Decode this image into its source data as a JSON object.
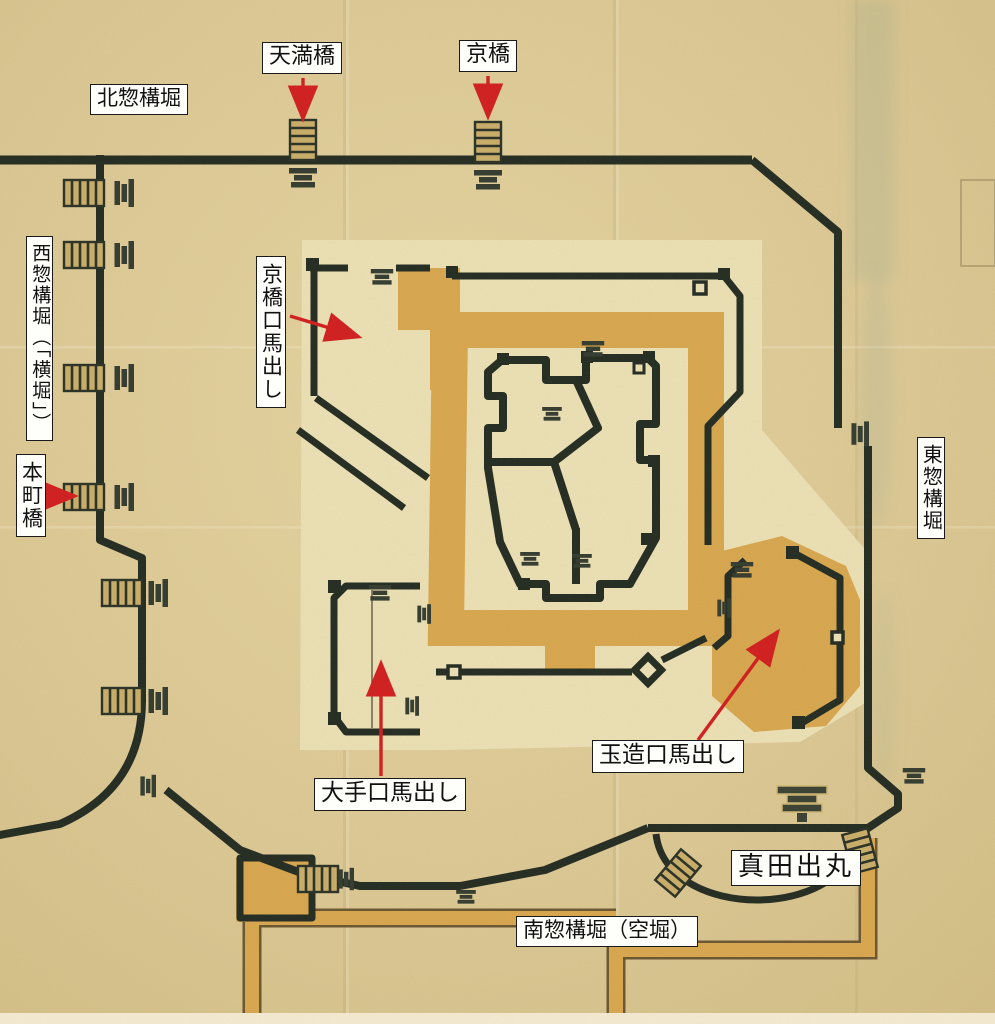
{
  "map_subject": "castle moat plan",
  "colors": {
    "paper": "#d9c58f",
    "paper_light": "#e8d8a8",
    "moat": "#7ba38d",
    "moat_edge": "#557f69",
    "wall": "#242c22",
    "ochre": "#d7a64f",
    "ochre_edge": "#6a5630",
    "cream": "#ebdfb4",
    "bridge": "#c9ad6a",
    "arrow": "#d01f1f",
    "label_bg": "#fefefa",
    "label_border": "#1a1a1a",
    "ink": "#111111"
  },
  "labels": [
    {
      "id": "kita-sogamae-bori",
      "text": "北惣構堀",
      "orientation": "horizontal"
    },
    {
      "id": "temma-bashi",
      "text": "天満橋",
      "orientation": "horizontal"
    },
    {
      "id": "kyo-bashi",
      "text": "京橋",
      "orientation": "horizontal"
    },
    {
      "id": "nishi-sogamae-bori",
      "text": "西惣構堀（「横堀」）",
      "orientation": "vertical"
    },
    {
      "id": "hommachi-bashi",
      "text": "本町橋",
      "orientation": "vertical"
    },
    {
      "id": "kyobashi-guchi-umadashi",
      "text": "京橋口馬出し",
      "orientation": "vertical"
    },
    {
      "id": "higashi-sogamae-bori",
      "text": "東惣構堀",
      "orientation": "vertical"
    },
    {
      "id": "ote-guchi-umadashi",
      "text": "大手口馬出し",
      "orientation": "horizontal"
    },
    {
      "id": "tamatsukuri-guchi-umadashi",
      "text": "玉造口馬出し",
      "orientation": "horizontal"
    },
    {
      "id": "sanada-demaru",
      "text": "真田出丸",
      "orientation": "horizontal"
    },
    {
      "id": "minami-sogamae-bori",
      "text": "南惣構堀（空堀）",
      "orientation": "horizontal"
    }
  ],
  "icons": {
    "bridge": "hatched-bridge-icon",
    "gate": "gate-step-icon",
    "pagoda": "pagoda-gate-icon"
  },
  "bridges": [
    {
      "x": 303,
      "y": 140,
      "r": 0
    },
    {
      "x": 488,
      "y": 142,
      "r": 0
    },
    {
      "x": 84,
      "y": 193,
      "r": 90
    },
    {
      "x": 84,
      "y": 255,
      "r": 90
    },
    {
      "x": 84,
      "y": 378,
      "r": 90
    },
    {
      "x": 84,
      "y": 497,
      "r": 90
    },
    {
      "x": 122,
      "y": 593,
      "r": 90
    },
    {
      "x": 122,
      "y": 701,
      "r": 90
    },
    {
      "x": 678,
      "y": 873,
      "r": 40
    },
    {
      "x": 860,
      "y": 851,
      "r": -15
    },
    {
      "x": 318,
      "y": 879,
      "r": 90
    }
  ],
  "gates": [
    {
      "x": 303,
      "y": 178,
      "r": 0,
      "s": 1
    },
    {
      "x": 488,
      "y": 180,
      "r": 0,
      "s": 1
    },
    {
      "x": 124,
      "y": 193,
      "r": 90,
      "s": 1
    },
    {
      "x": 124,
      "y": 255,
      "r": 90,
      "s": 1
    },
    {
      "x": 124,
      "y": 378,
      "r": 90,
      "s": 1
    },
    {
      "x": 124,
      "y": 497,
      "r": 90,
      "s": 1
    },
    {
      "x": 158,
      "y": 593,
      "r": 90,
      "s": 1
    },
    {
      "x": 158,
      "y": 701,
      "r": 90,
      "s": 1
    },
    {
      "x": 860,
      "y": 434,
      "r": 90,
      "s": 0.9
    },
    {
      "x": 914,
      "y": 776,
      "r": 0,
      "s": 0.8
    },
    {
      "x": 148,
      "y": 786,
      "r": 90,
      "s": 0.8
    },
    {
      "x": 346,
      "y": 879,
      "r": 90,
      "s": 0.8
    },
    {
      "x": 466,
      "y": 897,
      "r": 0,
      "s": 0.7
    },
    {
      "x": 382,
      "y": 277,
      "r": 0,
      "s": 0.8
    },
    {
      "x": 593,
      "y": 349,
      "r": 0,
      "s": 0.8
    },
    {
      "x": 552,
      "y": 414,
      "r": 0,
      "s": 0.7
    },
    {
      "x": 530,
      "y": 559,
      "r": 0,
      "s": 0.7
    },
    {
      "x": 582,
      "y": 561,
      "r": 0,
      "s": 0.7
    },
    {
      "x": 380,
      "y": 593,
      "r": 0,
      "s": 0.8
    },
    {
      "x": 424,
      "y": 614,
      "r": 90,
      "s": 0.7
    },
    {
      "x": 412,
      "y": 706,
      "r": 90,
      "s": 0.7
    },
    {
      "x": 742,
      "y": 570,
      "r": 0,
      "s": 0.8
    },
    {
      "x": 724,
      "y": 608,
      "r": 90,
      "s": 0.7
    }
  ],
  "pagoda_gate": {
    "x": 790,
    "y": 802
  },
  "arrows": [
    {
      "id": "arrow-temma-bashi",
      "x1": 303,
      "y1": 78,
      "x2": 303,
      "y2": 116
    },
    {
      "id": "arrow-kyo-bashi",
      "x1": 488,
      "y1": 76,
      "x2": 488,
      "y2": 114
    },
    {
      "id": "arrow-hommachi-bashi",
      "x1": 55,
      "y1": 496,
      "x2": 72,
      "y2": 496
    },
    {
      "id": "arrow-kyobashi-umadashi",
      "x1": 290,
      "y1": 316,
      "x2": 356,
      "y2": 336
    },
    {
      "id": "arrow-ote-umadashi",
      "x1": 381,
      "y1": 776,
      "x2": 381,
      "y2": 666
    },
    {
      "id": "arrow-tamatsukuri-umadashi",
      "x1": 698,
      "y1": 740,
      "x2": 776,
      "y2": 634
    }
  ]
}
